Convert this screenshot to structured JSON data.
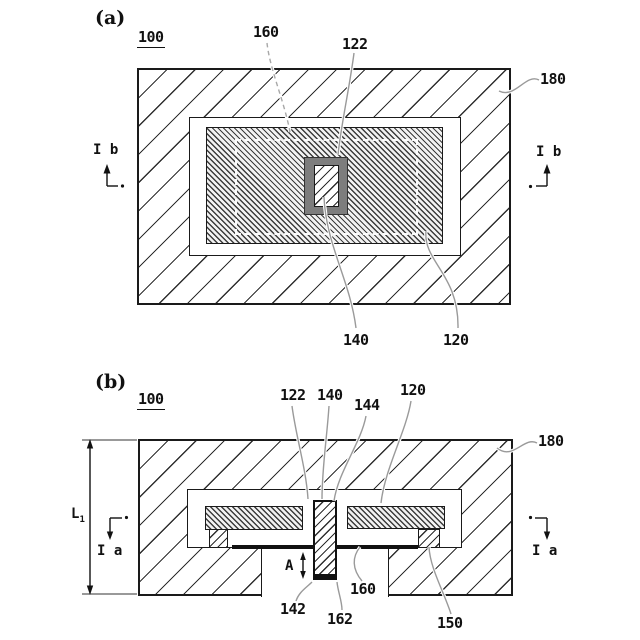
{
  "drawing": {
    "type": "patent-cross-section-figure",
    "colors": {
      "line": "#1a1a1a",
      "leader": "#9a9a9a",
      "frame_fill": "#7d7d7d",
      "membrane": "#111111",
      "background": "#ffffff"
    },
    "fig_a": {
      "tag": "(a)",
      "ref": "100",
      "label_160": "160",
      "label_122": "122",
      "label_140": "140",
      "label_120": "120",
      "label_180": "180",
      "section_left": "I b",
      "section_right": "I b"
    },
    "fig_b": {
      "tag": "(b)",
      "ref": "100",
      "label_122": "122",
      "label_140": "140",
      "label_144": "144",
      "label_120": "120",
      "label_180": "180",
      "label_142": "142",
      "label_162": "162",
      "label_160": "160",
      "label_150": "150",
      "dim_height": "L",
      "dim_height_sub": "1",
      "dim_gap": "A",
      "section_left": "I a",
      "section_right": "I a"
    }
  }
}
